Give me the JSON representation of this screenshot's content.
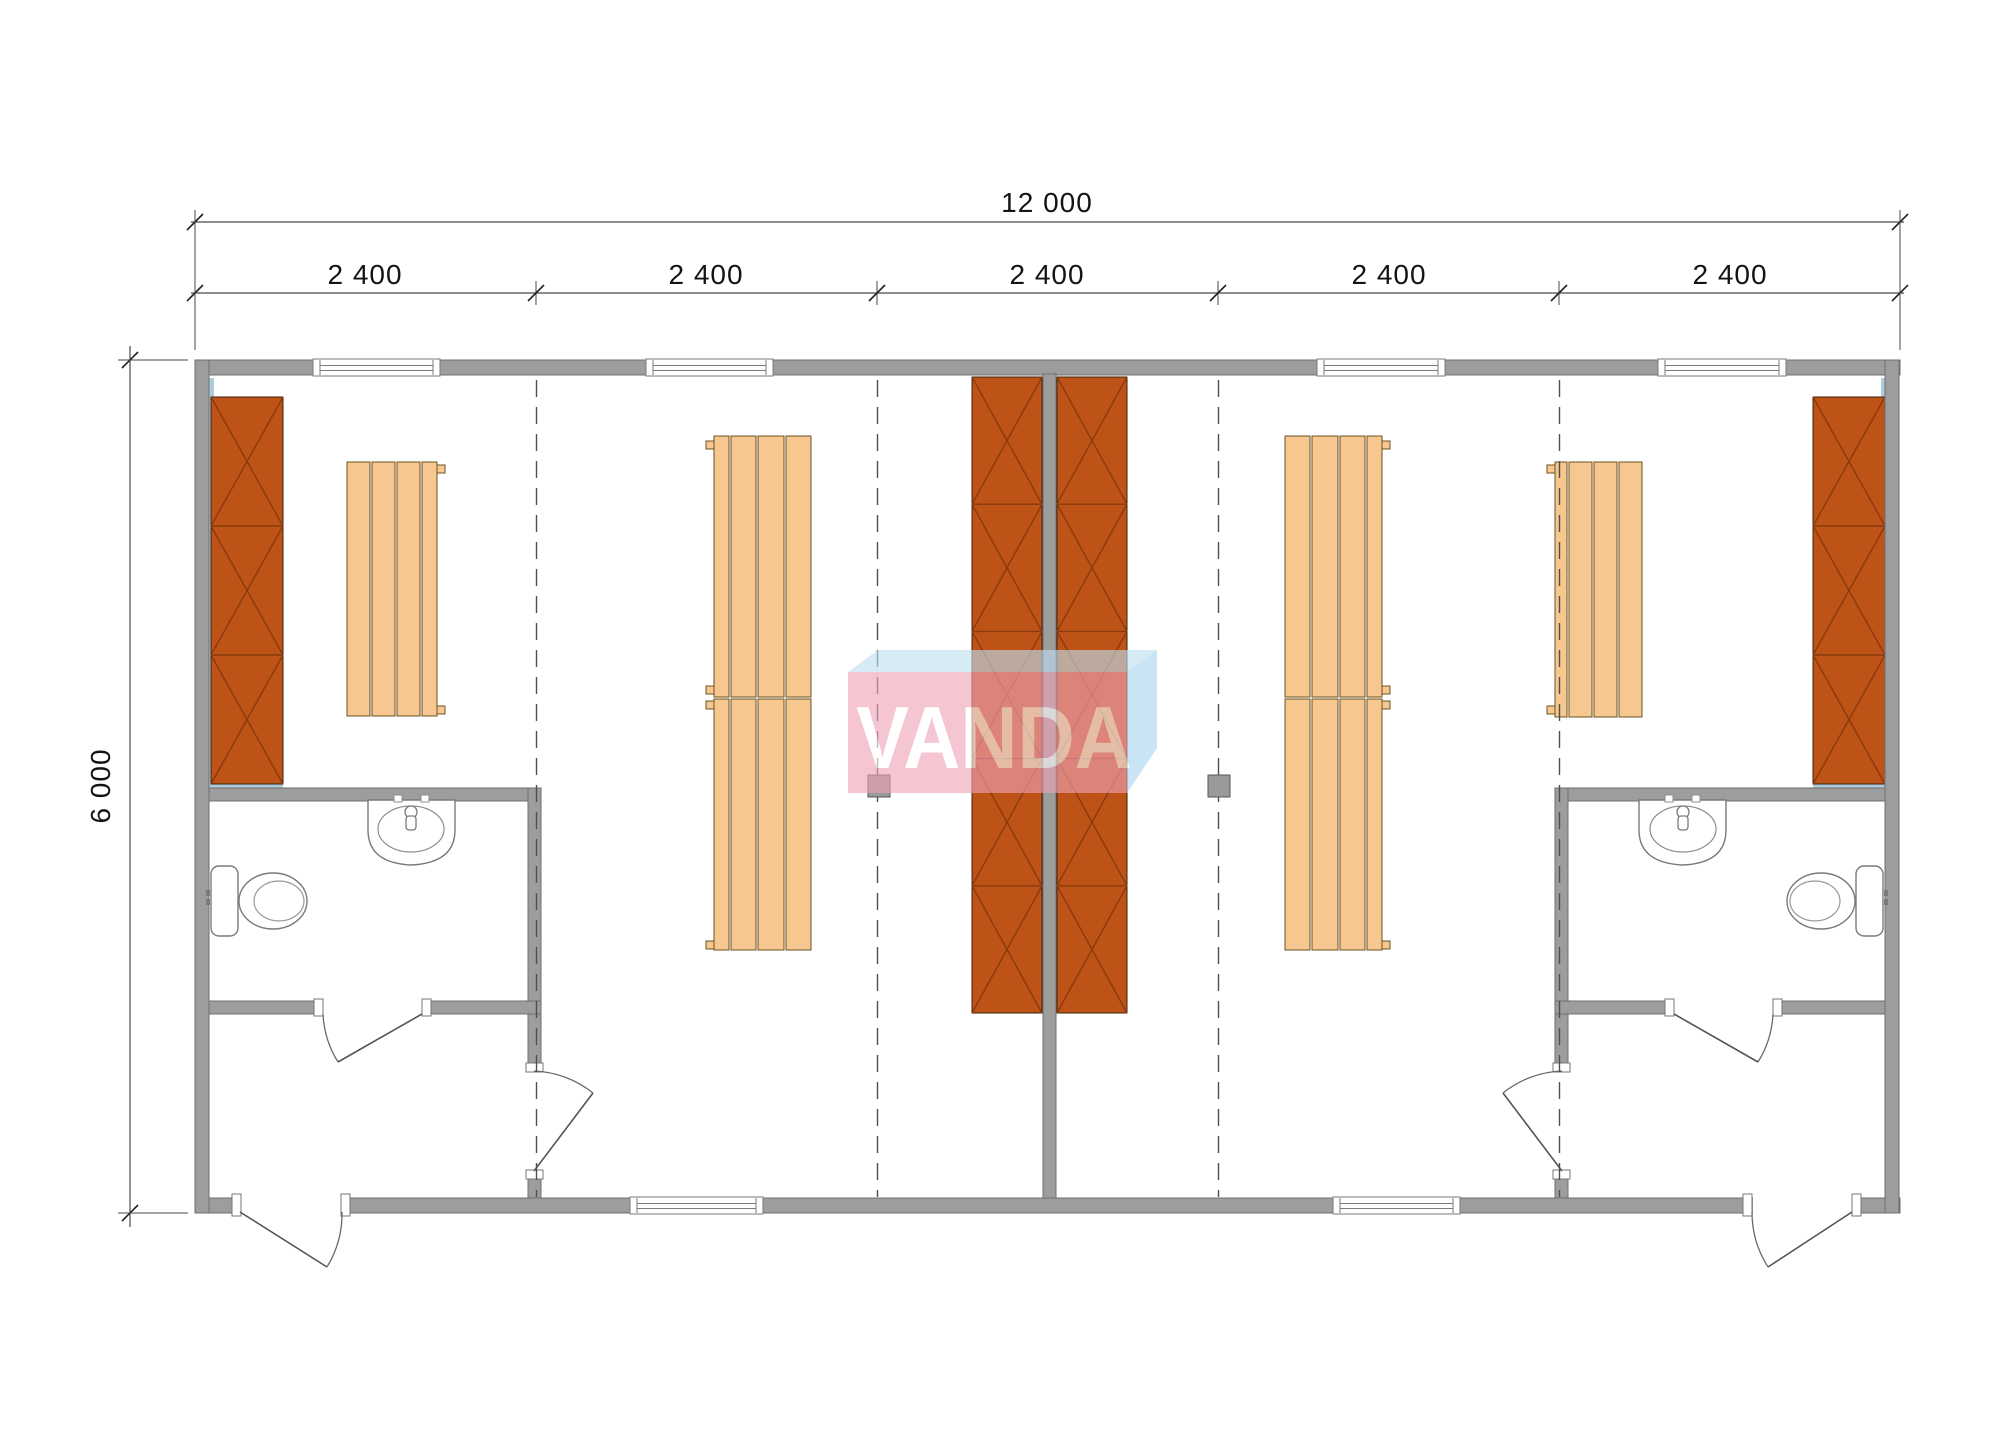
{
  "watermark": {
    "text": "VANDA",
    "front_color": "#f0a2b8",
    "top_color": "#bddff2",
    "side_color": "#a9d4ee",
    "text_color": "#ffffff"
  },
  "dimensions": {
    "total": {
      "label": "12 000"
    },
    "height": {
      "label": "6 000"
    },
    "bays": {
      "labels": [
        "2 400",
        "2 400",
        "2 400",
        "2 400",
        "2 400"
      ]
    }
  },
  "plan": {
    "colors": {
      "wall": "#9d9d9d",
      "wall_edge": "#6f6f6f",
      "cabinet": "#bd5316",
      "cabinet_line": "#8a3a0e",
      "cabinet_edge": "#42210a",
      "bench": "#f6c78e",
      "bench_edge": "#6b5322",
      "grid": "#4f4f4f",
      "lining": "#aecbdd",
      "fixture": "#7a7a7a",
      "stove": "#9a9a9a",
      "stove_edge": "#555555",
      "dim": "#4a4a4a",
      "tick": "#222222"
    },
    "walls": [
      [
        195,
        360,
        1705,
        15
      ],
      [
        195,
        1198,
        1705,
        15
      ],
      [
        195,
        360,
        14,
        853
      ],
      [
        1885,
        360,
        14,
        853
      ],
      [
        1043,
        374,
        13,
        824
      ],
      [
        209,
        788,
        332,
        13
      ],
      [
        528,
        788,
        13,
        410
      ],
      [
        209,
        1001,
        332,
        13
      ],
      [
        1555,
        788,
        330,
        13
      ],
      [
        1555,
        788,
        13,
        410
      ],
      [
        1555,
        1001,
        330,
        13
      ]
    ],
    "blue_strips": [
      [
        209,
        378,
        5,
        412
      ],
      [
        1881,
        378,
        5,
        412
      ],
      [
        211,
        784,
        72,
        6
      ],
      [
        1813,
        784,
        72,
        6
      ]
    ],
    "grid_lines": {
      "xs": [
        536.5,
        877.5,
        1218.5,
        1559.5
      ],
      "y1": 380,
      "y2": 1197,
      "dash": "17 10"
    },
    "cabinets": [
      {
        "x": 211,
        "y": 397,
        "w": 72,
        "h": 387,
        "seg": 3
      },
      {
        "x": 1813,
        "y": 397,
        "w": 72,
        "h": 387,
        "seg": 3
      },
      {
        "x": 972,
        "y": 377,
        "w": 70,
        "h": 636,
        "seg": 5
      },
      {
        "x": 1057,
        "y": 377,
        "w": 70,
        "h": 636,
        "seg": 5
      }
    ],
    "benches": [
      {
        "x": 347,
        "y": 462,
        "h": 254,
        "slats": [
          23,
          23,
          23,
          15
        ],
        "split": 0,
        "tab_side": "right",
        "tabs": [
          465,
          706
        ]
      },
      {
        "x": 714,
        "y": 436,
        "h": 514,
        "slats": [
          15,
          25,
          26,
          25
        ],
        "split": 698,
        "tab_side": "left",
        "tabs": [
          441,
          686,
          701,
          941
        ]
      },
      {
        "x": 1285,
        "y": 436,
        "h": 514,
        "slats": [
          25,
          26,
          25,
          15
        ],
        "split": 698,
        "tab_side": "right",
        "tabs": [
          441,
          686,
          701,
          941
        ]
      },
      {
        "x": 1555,
        "y": 462,
        "h": 255,
        "slats": [
          12,
          23,
          23,
          23
        ],
        "split": 0,
        "tab_side": "left",
        "tabs": [
          465,
          706
        ]
      }
    ],
    "stoves": [
      [
        868,
        775
      ],
      [
        1208,
        775
      ]
    ],
    "windows": {
      "top": {
        "y": 359,
        "h": 17,
        "spans": [
          [
            313,
            440
          ],
          [
            646,
            773
          ],
          [
            1317,
            1445
          ],
          [
            1658,
            1786
          ]
        ]
      },
      "bottom": {
        "y": 1197,
        "h": 17,
        "spans": [
          [
            630,
            763
          ],
          [
            1333,
            1460
          ]
        ]
      }
    },
    "doors": [
      {
        "opening": [
          241,
          1196,
          100,
          19
        ],
        "jambs": [
          [
            232,
            1194,
            9,
            22
          ],
          [
            341,
            1194,
            9,
            22
          ]
        ],
        "leaf": [
          240,
          1212,
          327,
          1267
        ],
        "arc": "M 342,1212 A 102,102 0 0 1 327,1267"
      },
      {
        "opening": [
          1753,
          1196,
          100,
          19
        ],
        "jambs": [
          [
            1743,
            1194,
            9,
            22
          ],
          [
            1852,
            1194,
            9,
            22
          ]
        ],
        "leaf": [
          1852,
          1212,
          1768,
          1267
        ],
        "arc": "M 1752,1212 A 102,102 0 0 0 1768,1267"
      },
      {
        "opening": [
          323,
          1000,
          99,
          15
        ],
        "jambs": [
          [
            314,
            999,
            9,
            17
          ],
          [
            422,
            999,
            9,
            17
          ]
        ],
        "leaf": [
          422,
          1014,
          338,
          1062
        ],
        "arc": "M 323,1014 A 99,99 0 0 0 338,1062"
      },
      {
        "opening": [
          1674,
          1000,
          99,
          15
        ],
        "jambs": [
          [
            1665,
            999,
            9,
            17
          ],
          [
            1773,
            999,
            9,
            17
          ]
        ],
        "leaf": [
          1674,
          1014,
          1758,
          1062
        ],
        "arc": "M 1773,1014 A 99,99 0 0 1 1758,1062"
      },
      {
        "opening": [
          527,
          1072,
          15,
          98
        ],
        "jambs": [
          [
            526,
            1063,
            17,
            9
          ],
          [
            526,
            1170,
            17,
            9
          ]
        ],
        "leaf": [
          534,
          1171,
          593,
          1093
        ],
        "arc": "M 534,1071 A 100,100 0 0 1 593,1093"
      },
      {
        "opening": [
          1554,
          1072,
          15,
          98
        ],
        "jambs": [
          [
            1553,
            1063,
            17,
            9
          ],
          [
            1553,
            1170,
            17,
            9
          ]
        ],
        "leaf": [
          1562,
          1171,
          1503,
          1093
        ],
        "arc": "M 1562,1071 A 100,100 0 0 0 1503,1093"
      }
    ],
    "fixture_mirror_x": 2094,
    "dims": {
      "total": {
        "y": 222,
        "x1": 195,
        "x2": 1900,
        "label_x": 1047,
        "label_y": 203
      },
      "bays": {
        "y": 293,
        "ticks": [
          195,
          536,
          877,
          1218,
          1559,
          1900
        ],
        "label_y": 275,
        "label_xs": [
          365,
          706,
          1047,
          1389,
          1730
        ]
      },
      "height": {
        "x": 130,
        "y1": 360,
        "y2": 1213,
        "label_x": 101,
        "label_y": 786
      },
      "ext_lines": [
        [
          195,
          350,
          195,
          210
        ],
        [
          1900,
          350,
          1900,
          210
        ],
        [
          188,
          360,
          118,
          360
        ],
        [
          188,
          1213,
          118,
          1213
        ]
      ]
    }
  }
}
